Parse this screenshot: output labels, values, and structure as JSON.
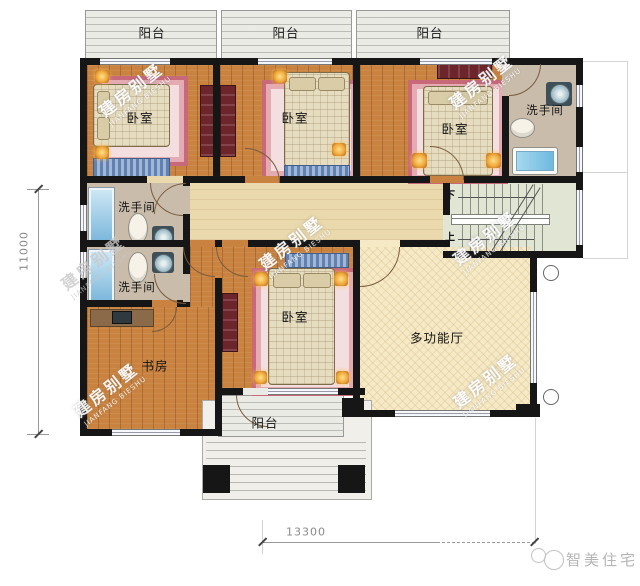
{
  "floorplan": {
    "rooms": {
      "balcony_top_1": {
        "label": "阳台"
      },
      "balcony_top_2": {
        "label": "阳台"
      },
      "balcony_top_3": {
        "label": "阳台"
      },
      "bedroom_top_left": {
        "label": "卧室"
      },
      "bedroom_top_middle": {
        "label": "卧室"
      },
      "bedroom_top_right": {
        "label": "卧室"
      },
      "bathroom_right": {
        "label": "洗手间"
      },
      "bathroom_upper_left": {
        "label": "洗手间"
      },
      "bathroom_lower_left": {
        "label": "洗手间"
      },
      "study": {
        "label": "书房"
      },
      "bedroom_bottom": {
        "label": "卧室"
      },
      "multi_function_hall": {
        "label": "多功能厅"
      },
      "balcony_bottom": {
        "label": "阳台"
      }
    },
    "stairs": {
      "down_label": "下",
      "up_label": "上"
    },
    "dimensions": {
      "horizontal": "13300",
      "vertical": "11000"
    },
    "watermark": {
      "cn": "建房别墅",
      "en": "JIANFANG BIESHU"
    },
    "brand": {
      "logo_text": "智美住宅"
    },
    "colors": {
      "wall": "#161616",
      "wood_floor": "#c9823f",
      "hallway_floor": "#ead9ad",
      "hall_floor": "#f5e9c6",
      "bath_floor": "#c9bcab",
      "stair_floor": "#e1e5d3",
      "rug_pink": "#c8697a",
      "lamp_accent": "#f0a93c",
      "water_blue": "#7db8dc"
    }
  }
}
